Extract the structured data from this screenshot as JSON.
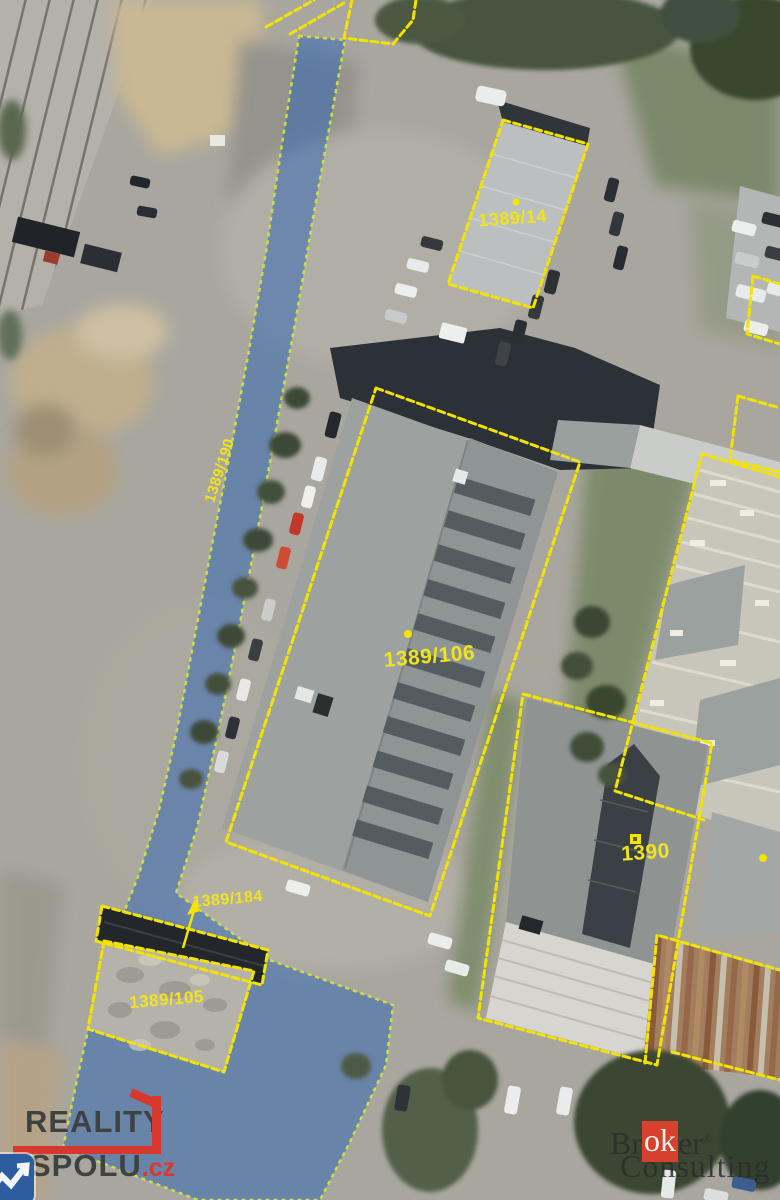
{
  "map": {
    "labels": {
      "p1389_14": "1389/14",
      "p1389_190": "1389/190",
      "p1389_106": "1389/106",
      "p1390": "1390",
      "p1389_184": "1389/184",
      "p1389_105": "1389/105"
    },
    "colors": {
      "parcel_boundary": "#f2e400",
      "parcel_label": "#f0e41e",
      "highlight_fill": "#2f66b5",
      "highlight_border": "#cbe040"
    }
  },
  "watermarks": {
    "reality_spolu": {
      "word1": "REALITY",
      "word2": "SPOLU",
      "suffix": ".cz",
      "red": "#d7382d"
    },
    "broker_consulting": {
      "part1": "Br",
      "part2": "ok",
      "part3": "er",
      "registered": "®",
      "line2": "Consulting",
      "red": "#d6402c"
    }
  }
}
